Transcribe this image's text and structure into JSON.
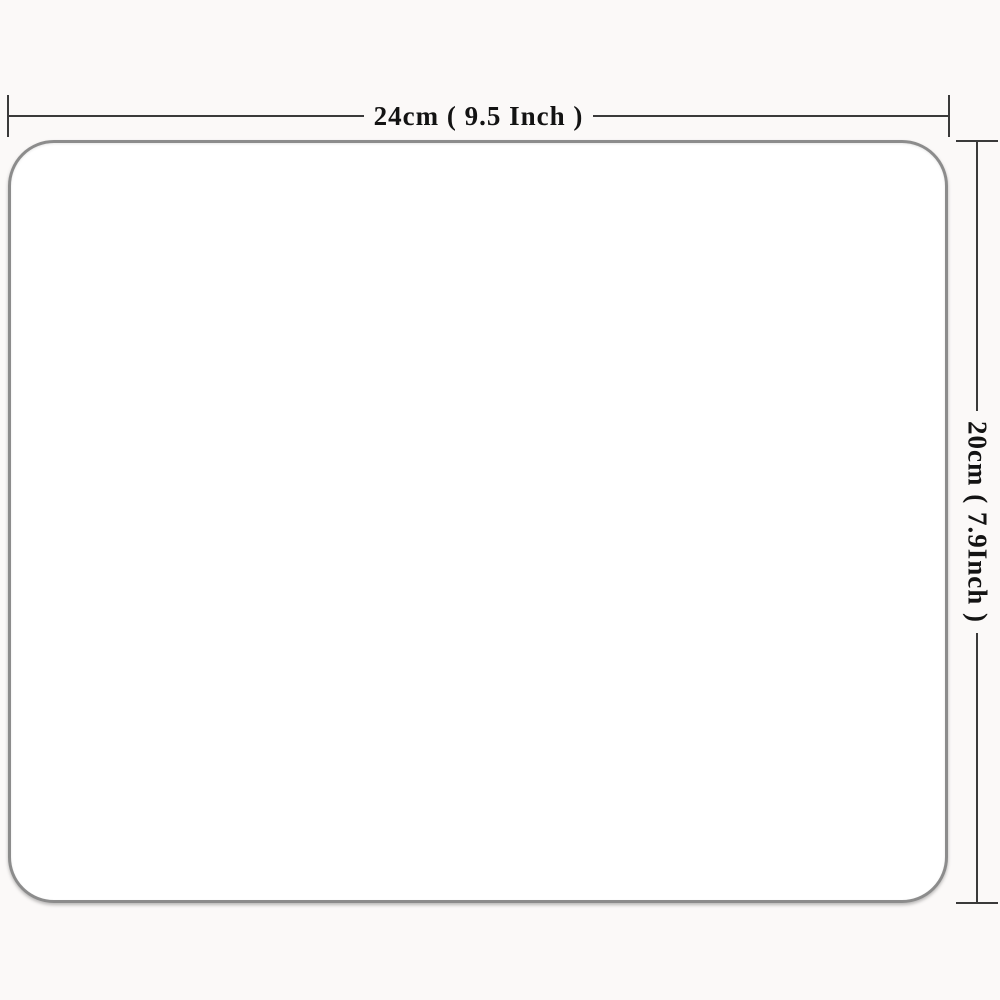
{
  "diagram": {
    "type": "product-dimension-diagram",
    "board": {
      "description": "blank white rounded-rectangle product surface",
      "fill": "#ffffff",
      "border_color": "#8c8c8c"
    },
    "width_dimension": {
      "label": "24cm ( 9.5 Inch )"
    },
    "height_dimension": {
      "label": "20cm ( 7.9Inch )"
    },
    "colors": {
      "dimension_line": "#3a3a3a",
      "label_text": "#131313",
      "page_background": "#fbf9f8"
    }
  }
}
